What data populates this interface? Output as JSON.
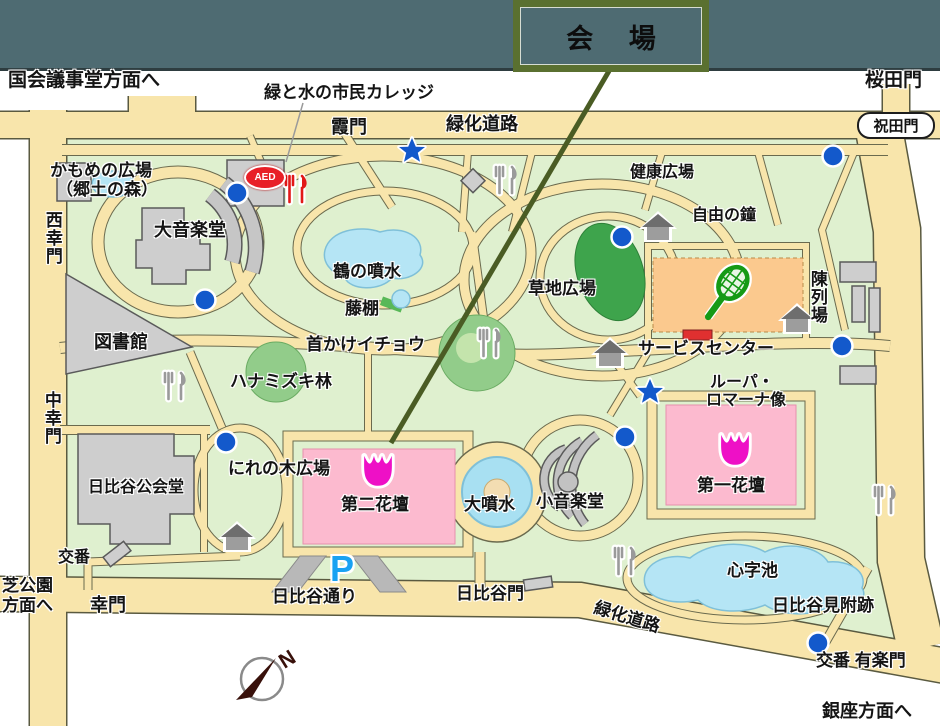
{
  "header": {
    "venue_label": "会 場"
  },
  "palette": {
    "top_band": "#4e6b72",
    "callout_border": "#5a7030",
    "pointer_line": "#4a5c24",
    "road_tan": "#f8e5ab",
    "park_green": "#dff0cf",
    "flowerbed_pink": "#fcbacf",
    "tulip_magenta": "#ee10c6",
    "marker_blue": "#1359cb",
    "court_orange": "#fbc98e",
    "pond_blue": "#b5e5f5",
    "lawn_dark_green": "#3ea44c",
    "aed_red": "#e81f27",
    "parking_blue": "#19a2f2"
  },
  "map": {
    "pill": {
      "text": "祝田門"
    },
    "aed": {
      "text": "AED"
    },
    "parking": {
      "text": "P"
    },
    "compass": {
      "text": "N"
    },
    "labels": [
      {
        "text": "国会議事堂方面へ",
        "x": 8,
        "y": 71,
        "size": 19
      },
      {
        "text": "桜田門",
        "x": 865,
        "y": 71,
        "size": 19
      },
      {
        "text": "緑と水の市民カレッジ",
        "x": 264,
        "y": 84,
        "size": 17
      },
      {
        "text": "霞門",
        "x": 331,
        "y": 118,
        "size": 18
      },
      {
        "text": "緑化道路",
        "x": 446,
        "y": 115,
        "size": 18
      },
      {
        "text": "健康広場",
        "x": 630,
        "y": 165,
        "size": 16
      },
      {
        "text": "かもめの広場",
        "x": 50,
        "y": 162,
        "size": 17
      },
      {
        "text": "（郷土の森）",
        "x": 56,
        "y": 181,
        "size": 17
      },
      {
        "text": "大音楽堂",
        "x": 154,
        "y": 221,
        "size": 18
      },
      {
        "text": "自由の鐘",
        "x": 692,
        "y": 208,
        "size": 16
      },
      {
        "text": "鶴の噴水",
        "x": 333,
        "y": 263,
        "size": 17
      },
      {
        "text": "草地広場",
        "x": 528,
        "y": 280,
        "size": 17
      },
      {
        "text": "藤棚",
        "x": 345,
        "y": 300,
        "size": 17
      },
      {
        "text": "図書館",
        "x": 94,
        "y": 333,
        "size": 18
      },
      {
        "text": "首かけイチョウ",
        "x": 306,
        "y": 336,
        "size": 17
      },
      {
        "text": "サービスセンター",
        "x": 638,
        "y": 340,
        "size": 17
      },
      {
        "text": "ハナミズキ林",
        "x": 230,
        "y": 373,
        "size": 17
      },
      {
        "text": "ルーパ・",
        "x": 710,
        "y": 375,
        "size": 16
      },
      {
        "text": "ロマーナ像",
        "x": 706,
        "y": 393,
        "size": 16
      },
      {
        "text": "にれの木広場",
        "x": 228,
        "y": 460,
        "size": 17
      },
      {
        "text": "第二花壇",
        "x": 341,
        "y": 496,
        "size": 17
      },
      {
        "text": "大噴水",
        "x": 464,
        "y": 496,
        "size": 17
      },
      {
        "text": "小音楽堂",
        "x": 536,
        "y": 493,
        "size": 17
      },
      {
        "text": "第一花壇",
        "x": 697,
        "y": 477,
        "size": 17
      },
      {
        "text": "日比谷公会堂",
        "x": 88,
        "y": 480,
        "size": 16
      },
      {
        "text": "交番",
        "x": 58,
        "y": 550,
        "size": 16
      },
      {
        "text": "心字池",
        "x": 727,
        "y": 562,
        "size": 17
      },
      {
        "text": "芝公園",
        "x": 2,
        "y": 577,
        "size": 17
      },
      {
        "text": "方面へ",
        "x": 2,
        "y": 597,
        "size": 17
      },
      {
        "text": "幸門",
        "x": 90,
        "y": 596,
        "size": 18
      },
      {
        "text": "日比谷通り",
        "x": 272,
        "y": 588,
        "size": 17
      },
      {
        "text": "日比谷門",
        "x": 456,
        "y": 585,
        "size": 17
      },
      {
        "text": "緑化道路",
        "x": 597,
        "y": 599,
        "rot": 17,
        "size": 17
      },
      {
        "text": "日比谷見附跡",
        "x": 772,
        "y": 597,
        "size": 17
      },
      {
        "text": "交番 有楽門",
        "x": 816,
        "y": 652,
        "size": 17
      },
      {
        "text": "銀座方面へ",
        "x": 822,
        "y": 702,
        "size": 18
      },
      {
        "text": "西幸門",
        "x": 43,
        "y": 211,
        "size": 17,
        "v": true
      },
      {
        "text": "中幸門",
        "x": 42,
        "y": 391,
        "size": 17,
        "v": true
      },
      {
        "text": "陳列場",
        "x": 808,
        "y": 270,
        "size": 17,
        "v": true
      }
    ],
    "markers": {
      "dots": [
        [
          237,
          193
        ],
        [
          205,
          300
        ],
        [
          622,
          237
        ],
        [
          833,
          156
        ],
        [
          842,
          346
        ],
        [
          226,
          442
        ],
        [
          625,
          437
        ],
        [
          818,
          643
        ]
      ],
      "stars": [
        [
          412,
          151
        ],
        [
          650,
          392
        ]
      ],
      "forks_gray": [
        [
          506,
          180
        ],
        [
          175,
          386
        ],
        [
          490,
          343
        ],
        [
          625,
          561
        ],
        [
          885,
          500
        ]
      ],
      "forks_red": [
        [
          296,
          189
        ]
      ],
      "houses": [
        [
          658,
          226
        ],
        [
          797,
          318
        ],
        [
          610,
          352
        ],
        [
          237,
          536
        ]
      ],
      "tulips": [
        [
          378,
          472
        ],
        [
          735,
          451
        ]
      ]
    }
  }
}
